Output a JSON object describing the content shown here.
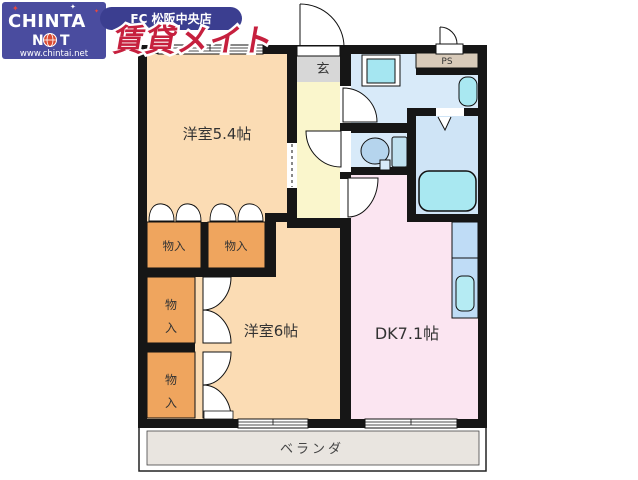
{
  "logo": {
    "brand_line1": "CHINTA",
    "brand_n": "N",
    "brand_t": "T",
    "url": "www.chintai.net",
    "banner": "FC 松阪中央店",
    "brand_name": "賃貸メイト",
    "star": "✦"
  },
  "plan": {
    "room_west_54": "洋室5.4帖",
    "room_west_6": "洋室6帖",
    "room_dk": "DK7.1帖",
    "entrance": "玄",
    "pipe_shaft": "PS",
    "storage": "物入",
    "storage_char_top": "物",
    "storage_char_bottom": "入",
    "veranda": "ベランダ"
  },
  "colors": {
    "wall": "#161616",
    "room_peach": "#FBDCB4",
    "closet_orange": "#EFA55E",
    "hallway_yellow": "#FAF6CC",
    "entrance_gray": "#D7D7D7",
    "wet_blue": "#D8EAF9",
    "bath_blue": "#CFE4F6",
    "dk_pink": "#FBE5F1",
    "counter_blue": "#BFDCF6",
    "fixture_cyan": "#A9E8F1",
    "washer_cyan": "#A5E6F1",
    "sink_cyan": "#B5EBF3",
    "toilet_bowl": "#B5D4ED",
    "toilet_tank": "#BFE0EF",
    "ps_tan": "#D8CAB9",
    "veranda_gray": "#E9E5E0",
    "brand_blue": "#4A4C9F",
    "banner_blue": "#3B3E90",
    "brand_red": "#C6203E"
  }
}
